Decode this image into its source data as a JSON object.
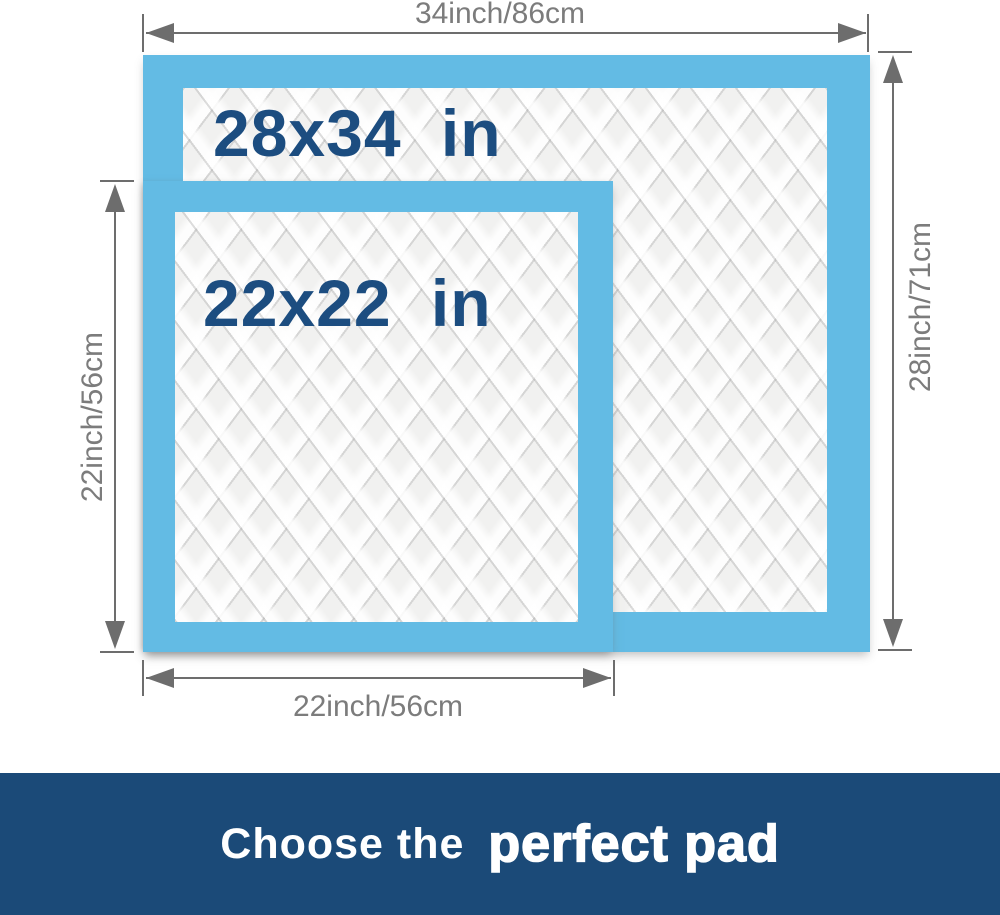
{
  "colors": {
    "pad_blue": "#63bbe4",
    "quilt_base": "#f1f1f0",
    "size_label_navy": "#1c4d80",
    "dim_line_gray": "#6d6d6d",
    "dim_text_gray": "#7c7c7c",
    "banner_bg": "#1b4a78",
    "banner_text": "#ffffff"
  },
  "pads": {
    "large": {
      "label": "28x34 in"
    },
    "small": {
      "label": "22x22 in"
    }
  },
  "dimensions": {
    "top_width": "34inch/86cm",
    "right_height": "28inch/71cm",
    "left_height": "22inch/56cm",
    "bottom_width": "22inch/56cm"
  },
  "banner": {
    "prefix": "Choose the",
    "highlight": "perfect pad"
  }
}
